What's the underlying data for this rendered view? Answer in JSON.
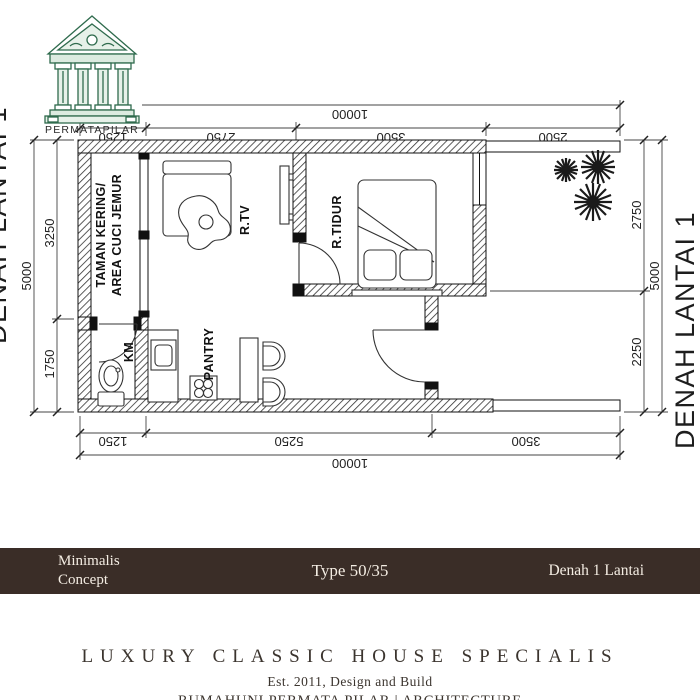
{
  "logo": {
    "brand": "PERMATAPILAR"
  },
  "colors": {
    "band_bg": "#3a2d27",
    "logo_green": "#2f6b4d",
    "ink": "#1c1c1c"
  },
  "plan": {
    "side_title": "DENAH LANTAI 1",
    "side_title_cropped": "DENAH LANTAI 1",
    "rooms": {
      "garden_line1": "TAMAN KERING/",
      "garden_line2": "AREA CUCI JEMUR",
      "tv": "R.TV",
      "bedroom": "R.TIDUR",
      "bathroom": "KM",
      "pantry": "PANTRY"
    },
    "dims": {
      "top_overall": "10000",
      "top_segments": [
        "1250",
        "2750",
        "3500",
        "2500"
      ],
      "bottom_segments": [
        "1250",
        "5250",
        "3500"
      ],
      "bottom_overall": "10000",
      "left_segments": [
        "3250",
        "1750"
      ],
      "left_overall": "5000",
      "right_segments": [
        "2750",
        "2250"
      ],
      "right_overall": "5000"
    }
  },
  "band": {
    "left_line1": "Minimalis",
    "left_line2": "Concept",
    "center": "Type 50/35",
    "right": "Denah 1 Lantai"
  },
  "footer": {
    "title": "LUXURY CLASSIC HOUSE SPECIALIS",
    "subtitle": "Est. 2011, Design and Build",
    "brand_line": "RUMAHUNI PERMATA PILAR | ARCHITECTURE"
  }
}
